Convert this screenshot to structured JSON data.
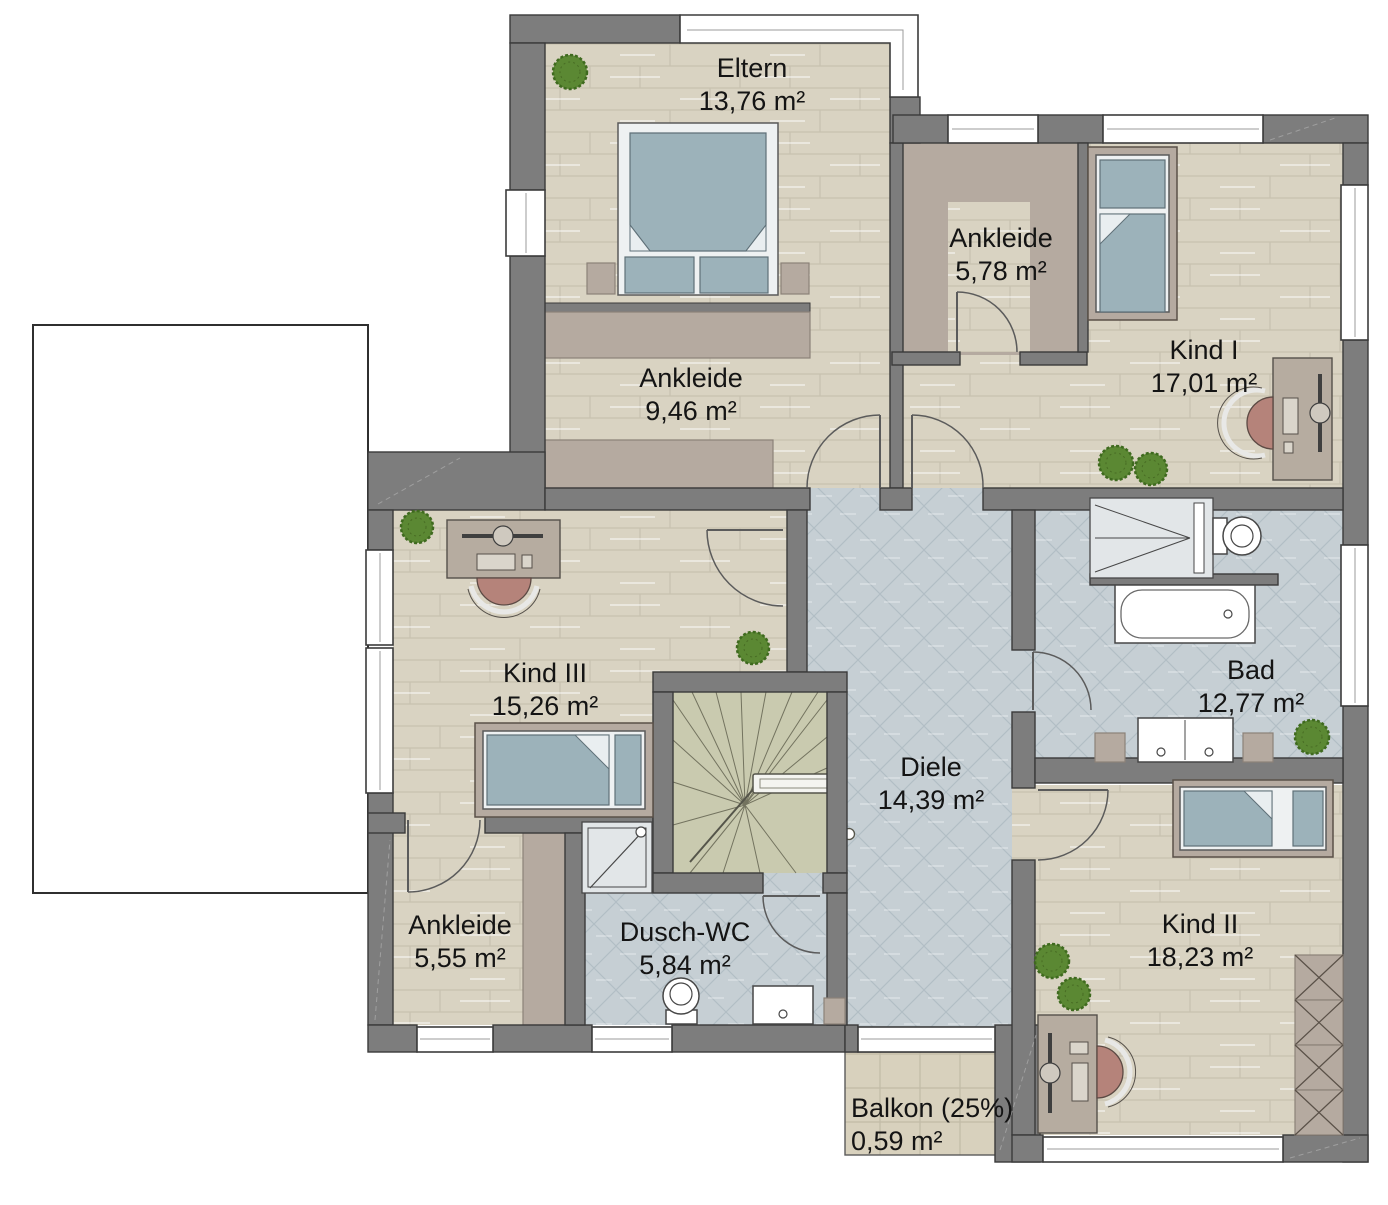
{
  "plan": {
    "type": "floor-plan-upper-storey",
    "language": "de",
    "rooms": [
      {
        "id": "eltern",
        "name": "Eltern",
        "area": "13,76 m²"
      },
      {
        "id": "ankleide-578",
        "name": "Ankleide",
        "area": "5,78 m²"
      },
      {
        "id": "kind-1",
        "name": "Kind I",
        "area": "17,01 m²"
      },
      {
        "id": "ankleide-946",
        "name": "Ankleide",
        "area": "9,46 m²"
      },
      {
        "id": "kind-3",
        "name": "Kind III",
        "area": "15,26 m²"
      },
      {
        "id": "bad",
        "name": "Bad",
        "area": "12,77 m²"
      },
      {
        "id": "diele",
        "name": "Diele",
        "area": "14,39 m²"
      },
      {
        "id": "ankleide-555",
        "name": "Ankleide",
        "area": "5,55 m²"
      },
      {
        "id": "dusch-wc",
        "name": "Dusch-WC",
        "area": "5,84 m²"
      },
      {
        "id": "kind-2",
        "name": "Kind II",
        "area": "18,23 m²"
      },
      {
        "id": "balkon",
        "name": "Balkon (25%)",
        "area": "0,59 m²"
      }
    ],
    "colors": {
      "wall": "#7d7d7d",
      "wallStroke": "#3a3a3a",
      "winStroke": "#3c3c3c",
      "door": "#5b5b5b",
      "wood": "#d9d3c2",
      "woodLine": "#c7c1b0",
      "taupe": "#b5aaa0",
      "taupeStroke": "#8b8178",
      "tile": "#c6cfd4",
      "tileLine": "#b2bec5",
      "stairs": "#c9caaf",
      "stairLine": "#73735f",
      "balcony": "#d8d1bd",
      "balconyLine": "#c2bba6",
      "mattress": "#9cb2ba",
      "mattressStroke": "#5f7078",
      "bedFrame": "#eef1f2",
      "desk": "#b6aca0",
      "chair": "#b5837a",
      "plant": "#5b8833",
      "plantDark": "#3f6a1f",
      "text": "#141414"
    }
  }
}
